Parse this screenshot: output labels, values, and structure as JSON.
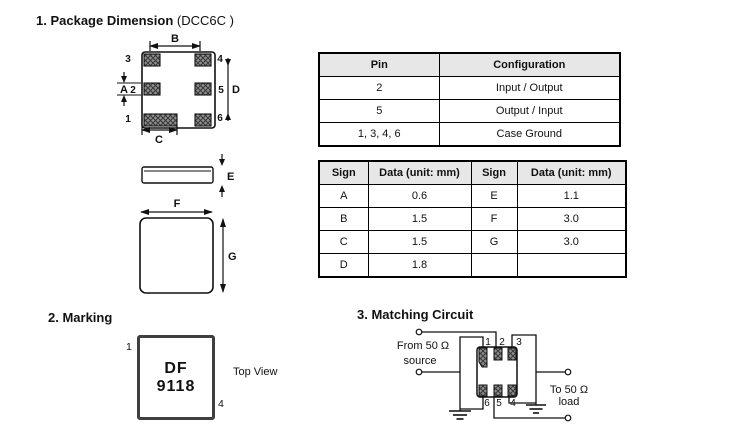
{
  "colors": {
    "line": "#111111",
    "table_header_bg": "#e7e7e7",
    "pad_fill": "#8f8f8f",
    "pad_hatch": "#3a3a3a",
    "marking_border": "#3f3f3f"
  },
  "package_dimension": {
    "heading": "1. Package Dimension",
    "heading_suffix": "(DCC6C )",
    "pin_labels": {
      "p1": "1",
      "p2": "2",
      "p3": "3",
      "p4": "4",
      "p5": "5",
      "p6": "6"
    },
    "dim_labels": {
      "A": "A",
      "B": "B",
      "C": "C",
      "D": "D",
      "E": "E",
      "F": "F",
      "G": "G"
    }
  },
  "pin_table": {
    "headers": [
      "Pin",
      "Configuration"
    ],
    "rows": [
      [
        "2",
        "Input / Output"
      ],
      [
        "5",
        "Output / Input"
      ],
      [
        "1, 3, 4, 6",
        "Case Ground"
      ]
    ]
  },
  "dim_table": {
    "headers": [
      "Sign",
      "Data (unit: mm)",
      "Sign",
      "Data (unit: mm)"
    ],
    "rows": [
      [
        "A",
        "0.6",
        "E",
        "1.1"
      ],
      [
        "B",
        "1.5",
        "F",
        "3.0"
      ],
      [
        "C",
        "1.5",
        "G",
        "3.0"
      ],
      [
        "D",
        "1.8",
        "",
        ""
      ]
    ]
  },
  "marking": {
    "heading": "2. Marking",
    "line1": "DF",
    "line2": "9118",
    "pin_top_left": "1",
    "pin_bottom_right": "4",
    "caption": "Top View"
  },
  "matching_circuit": {
    "heading": "3. Matching Circuit",
    "source_line1": "From 50 Ω",
    "source_line2": "source",
    "load_line1": "To 50 Ω",
    "load_line2": "load",
    "top_pins": [
      "1",
      "2",
      "3"
    ],
    "bottom_pins": [
      "6",
      "5",
      "4"
    ]
  }
}
